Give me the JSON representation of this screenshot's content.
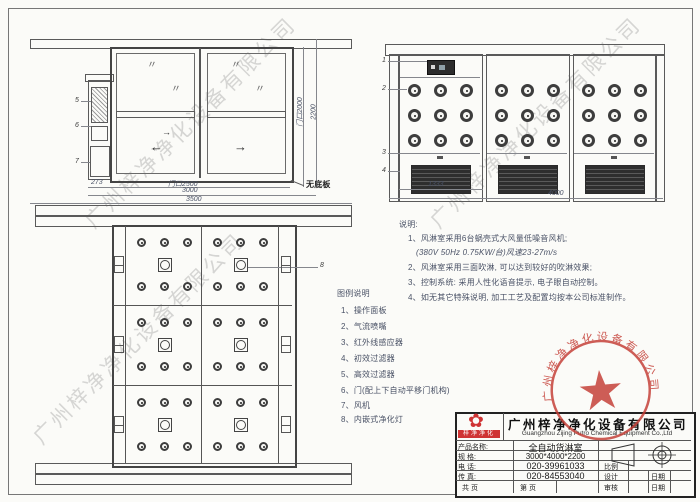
{
  "watermark": {
    "text": "广州梓净净化设备有限公司"
  },
  "front_view": {
    "glass_mark": "〃",
    "arrow_left": "←",
    "arrow_right": "→",
    "arrow_small": "→",
    "label_5": "5",
    "label_6": "6",
    "label_7": "7",
    "dim_273": "273",
    "dim_door_w": "门口2500",
    "dim_3000": "3000",
    "dim_3500": "3500",
    "dim_door_h": "门口2000",
    "dim_2200": "2200",
    "no_base_label": "无底板"
  },
  "side_view": {
    "label_1": "1",
    "label_2": "2",
    "label_3": "3",
    "label_4": "4",
    "dim_1333": "1333",
    "dim_4000": "4000"
  },
  "plan_view": {
    "label_8": "8"
  },
  "notes": {
    "title": "说明:",
    "lines": [
      "1、风淋室采用6台蜗壳式大风量低噪音风机;",
      "(380V  50Hz  0.75KW/台)风速23-27m/s",
      "2、风淋室采用三面吹淋, 可以达到较好的吹淋效果;",
      "3、控制系统: 采用人性化语音提示, 电子眼自动控制。",
      "4、如无其它特殊说明, 加工工艺及配置均按本公司标准制作。"
    ]
  },
  "legend": {
    "title": "图例说明",
    "items": [
      "1、操作面板",
      "2、气流喷嘴",
      "3、红外线感应器",
      "4、初效过滤器",
      "5、高效过滤器",
      "6、门(配上下自动平移门机构)",
      "7、风机",
      "8、内嵌式净化灯"
    ]
  },
  "title_block": {
    "logo_text": "梓净净化",
    "logo_glyph": "✿",
    "company_cn": "广州梓净净化设备有限公司",
    "company_en": "Guangzhou Zijing Putro Chemical Equipment Co.,Ltd",
    "product_label": "产品名称:",
    "product_value": "全自动货淋室",
    "spec_label": "规  格:",
    "spec_value": "3000*4000*2200",
    "tel_label": "电  话:",
    "tel_value": "020-39961033",
    "fax_label": "传  真:",
    "fax_value": "020-84553040",
    "pages_left": "共  页",
    "pages_right": "第  页",
    "scale_label": "比例",
    "design_label": "设计",
    "audit_label": "审核",
    "date_label": "日期",
    "date_label2": "日期"
  },
  "stamp": {
    "ring_text": "广州梓净净化设备有限公司",
    "star": "★"
  }
}
